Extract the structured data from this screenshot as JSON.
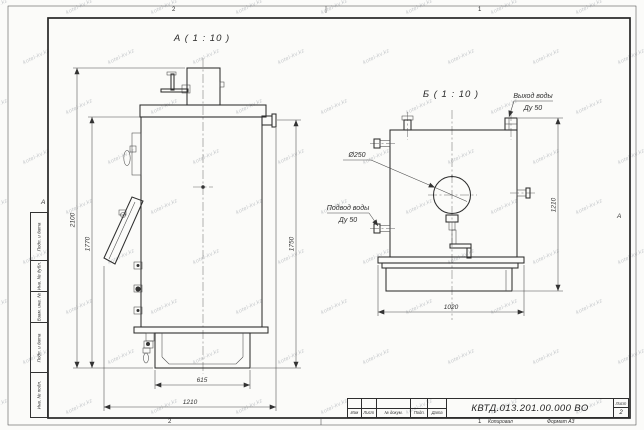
{
  "sheet": {
    "watermark": "kotel-kv.kz",
    "zones": {
      "top_left": "2",
      "top_right": "1",
      "bottom_left": "2",
      "bottom_right": "1"
    },
    "fold_marks": {
      "left": "А",
      "right": "А"
    }
  },
  "side_strip": {
    "cells": [
      "Подп. и дата",
      "Инв. № дубл.",
      "Взам. инв. №",
      "Подп. и дата",
      "Инв. № подл."
    ]
  },
  "view_a": {
    "title": "А ( 1 : 10 )",
    "dim_total_height": "2100",
    "dim_inner_height": "1770",
    "dim_right_height": "1750",
    "dim_base_width": "615",
    "dim_total_width": "1210"
  },
  "view_b": {
    "title": "Б ( 1 : 10 )",
    "label_diameter": "Ø250",
    "outlet": {
      "line1": "Выход воды",
      "line2": "Ду 50"
    },
    "inlet": {
      "line1": "Подвод воды",
      "line2": "Ду 50"
    },
    "dim_right_height": "1210",
    "dim_bottom_width": "1020"
  },
  "title_block": {
    "doc_number": "КВТД.013.201.00.000 ВО",
    "sheet_label": "Лист",
    "sheet_number": "2",
    "cols": [
      "Изм",
      "Лист",
      "№ докум.",
      "Подп.",
      "Дата"
    ],
    "footer_copy": "Копировал",
    "footer_format": "Формат А3"
  }
}
